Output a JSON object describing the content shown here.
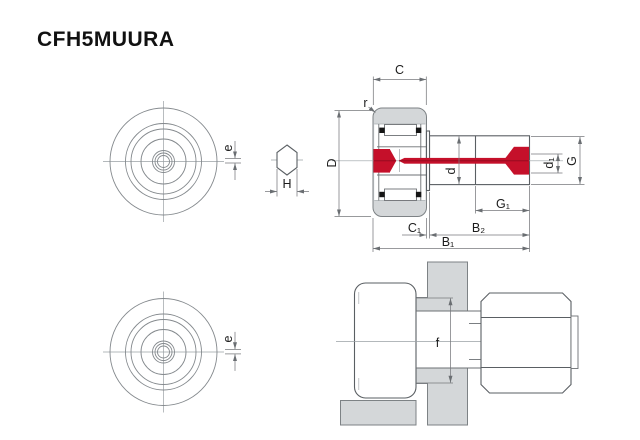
{
  "title": "CFH5MUURA",
  "colors": {
    "accent_red": "#c5102a",
    "part_gray": "#d4d7d9"
  },
  "dimension_labels": {
    "C": "C",
    "r": "r",
    "D": "D",
    "d": "d",
    "d1": "d₁",
    "G": "G",
    "G1": "G₁",
    "C1": "C₁",
    "B2": "B₂",
    "B1": "B₁",
    "e": "e",
    "H": "H",
    "f": "f"
  }
}
